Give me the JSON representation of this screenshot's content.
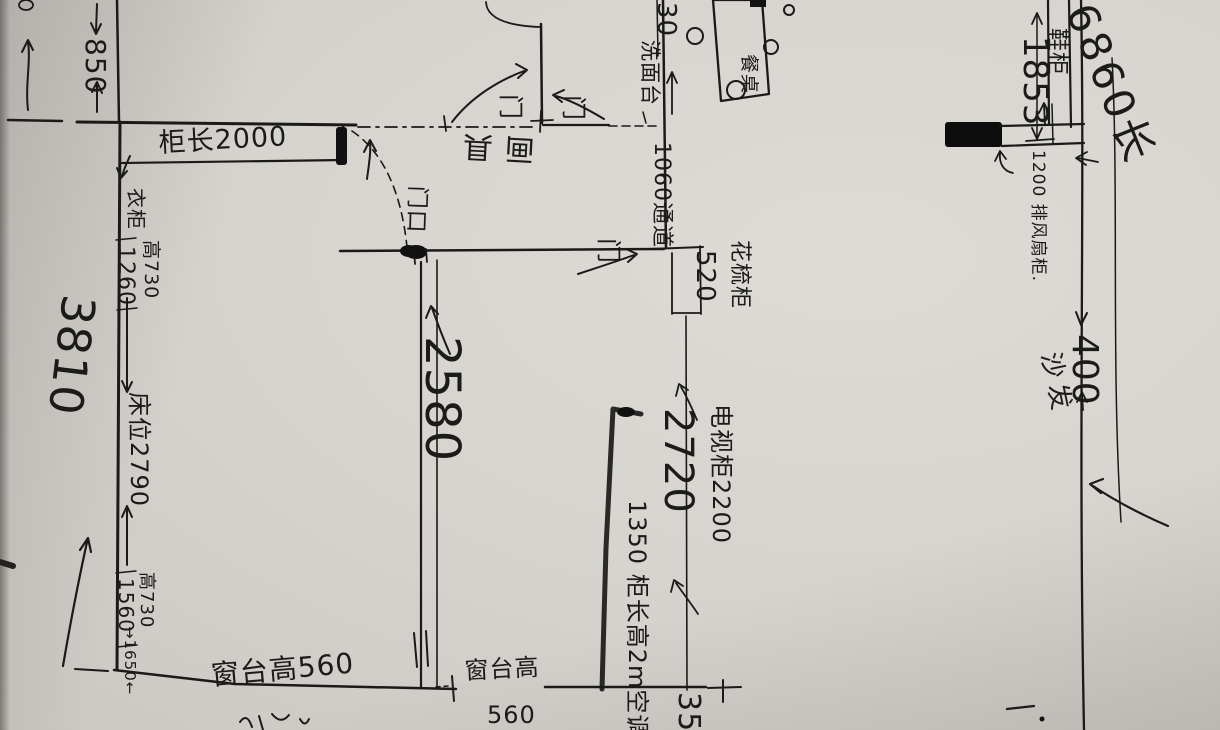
{
  "meta": {
    "kind": "hand-drawn floor plan sketch",
    "language": "zh"
  },
  "colors": {
    "paper": "#d6d3ce",
    "ink": "#1a1a18"
  },
  "labels": {
    "dim_850": "850",
    "cabinet_2000": "柜长2000",
    "wardrobe": "衣柜",
    "height_730_top": "高730",
    "dim_1260": "1260",
    "dim_3810": "3810",
    "bed_2790": "床位2790",
    "height_730_bottom": "高730",
    "dim_1560": "1560",
    "dim_1650": "→1650←",
    "window_sill_left": "窗台高560",
    "window_sill_mid": "窗台高",
    "window_sill_mid_value": "560",
    "dim_2580": "2580",
    "door_opening": "门口",
    "door_top_1": "门",
    "door_top_2": "门",
    "door_mid": "门",
    "wash_basin": "洗面台",
    "partial_30": "30",
    "passage_1060": "1060通道",
    "flipped_text": "画具",
    "dresser": "花梳柜",
    "dresser_520": "520",
    "tv_cabinet_2200": "电视柜2200",
    "dim_2720": "2720",
    "closet_column": "1350 柜长高2m空调",
    "dim_350": "350",
    "dining_table": "餐桌",
    "total_length_6860": "6860长",
    "dim_1853": "1853",
    "shoe_cabinet": "鞋柜",
    "fan_cabinet_1200": "1200 排风扇柜.",
    "dim_400": "400",
    "sofa": "沙发"
  }
}
